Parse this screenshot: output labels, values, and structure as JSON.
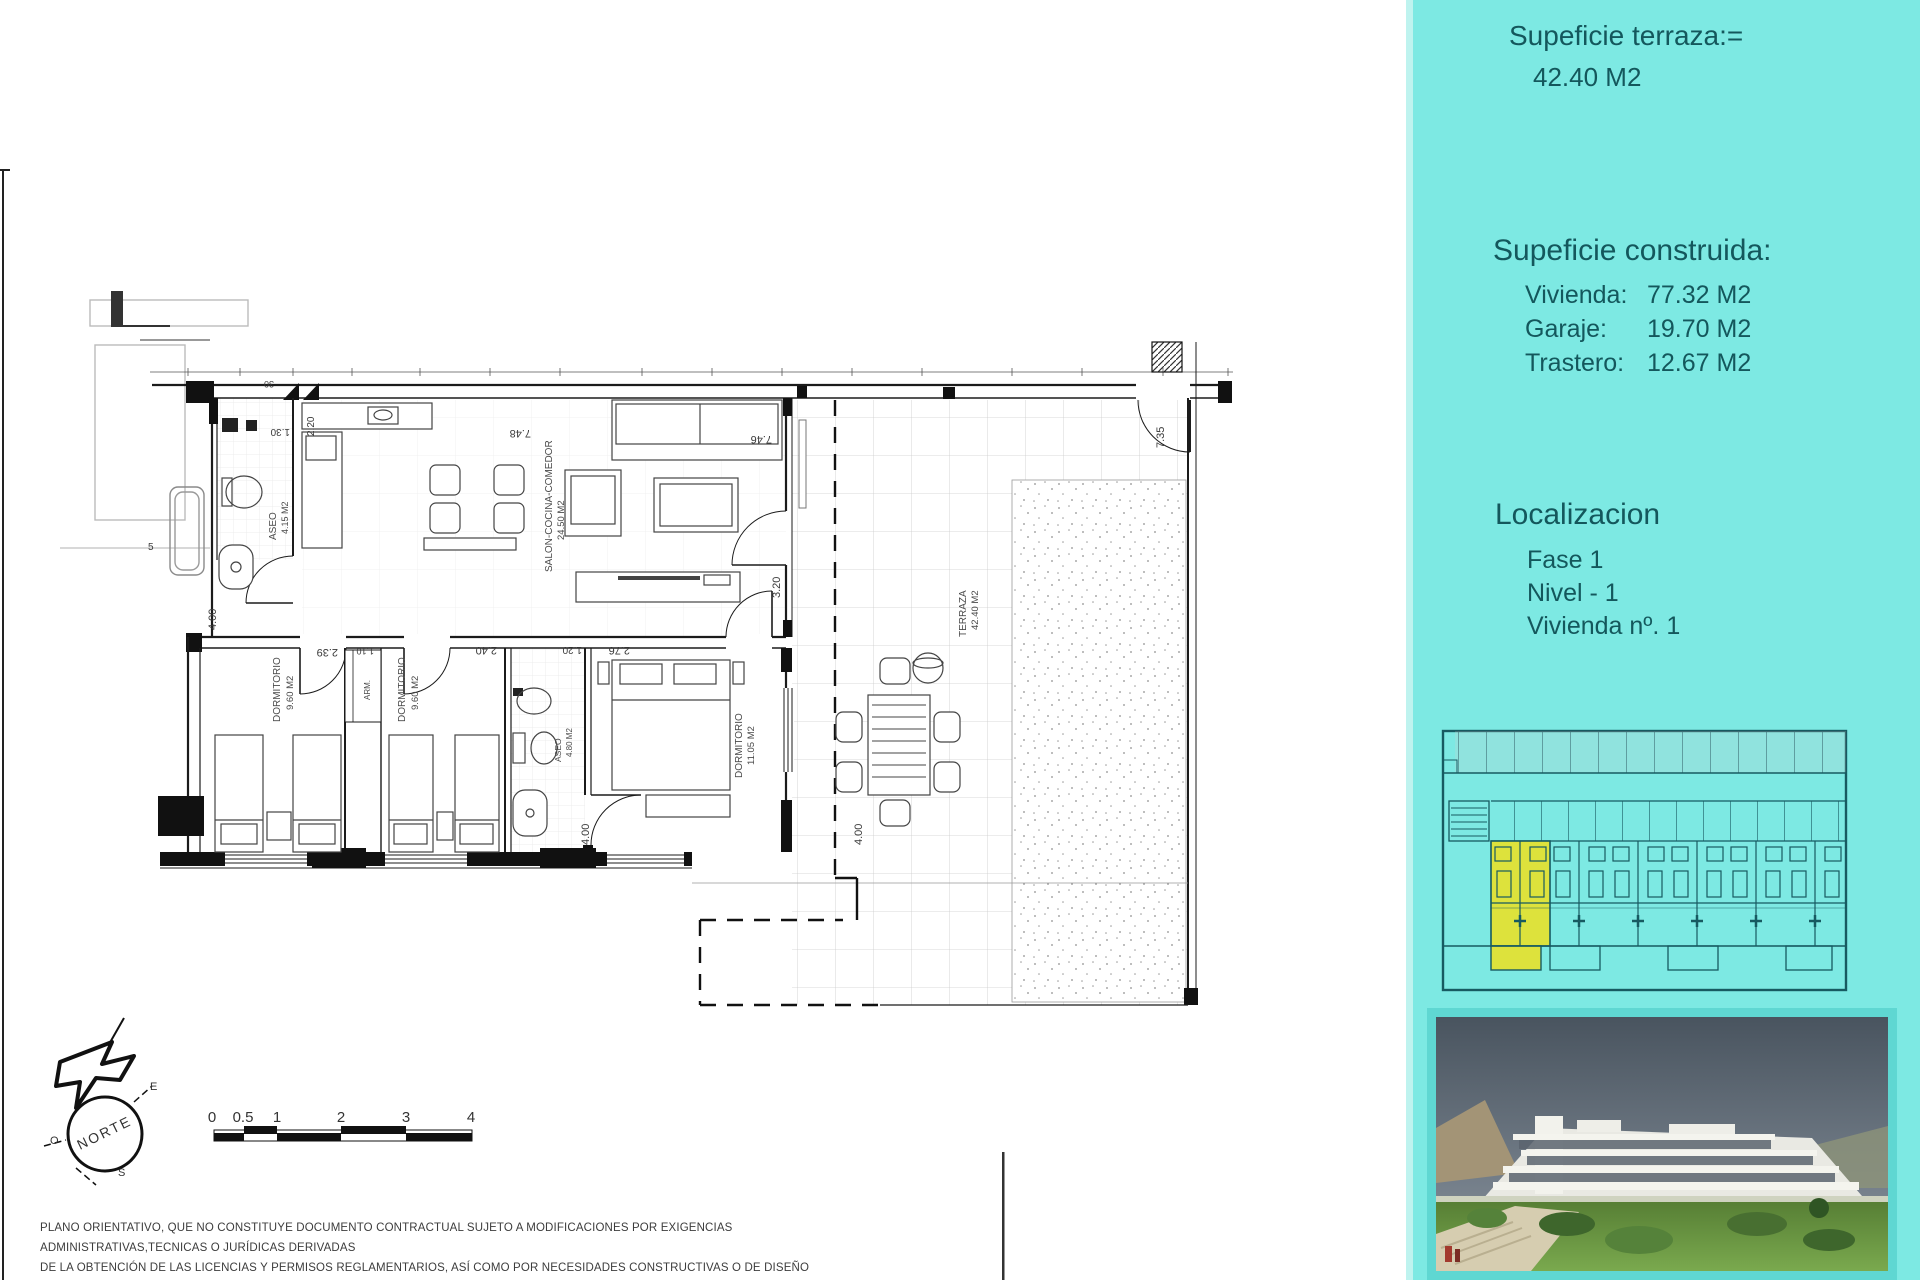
{
  "panel": {
    "terraza_title": "Supeficie terraza:=",
    "terraza_value": "42.40 M2",
    "construida_title": "Supeficie construida:",
    "construida_rows": [
      {
        "label": "Vivienda:",
        "value": "77.32 M2"
      },
      {
        "label": "Garaje:",
        "value": "19.70 M2"
      },
      {
        "label": "Trastero:",
        "value": "12.67 M2"
      }
    ],
    "localizacion_title": "Localizacion",
    "localizacion_rows": [
      "Fase 1",
      "Nivel - 1",
      "Vivienda nº. 1"
    ]
  },
  "plan": {
    "rooms": [
      {
        "name": "ASEO",
        "area": "4.15 M2"
      },
      {
        "name": "SALON-COCINA-COMEDOR",
        "area": "24.50 M2"
      },
      {
        "name": "DORMITORIO",
        "area": "9.60 M2"
      },
      {
        "name": "DORMITORIO",
        "area": "9.60 M2"
      },
      {
        "name": "ASEO",
        "area": "4.80 M2"
      },
      {
        "name": "DORMITORIO",
        "area": "11.05 M2"
      },
      {
        "name": "TERRAZA",
        "area": "42.40 M2"
      },
      {
        "name": "ARM.",
        "area": ""
      }
    ],
    "dims": {
      "d748": "7.48",
      "d746": "7.46",
      "d735": "7.35",
      "d320": "3.20",
      "d239": "2.39",
      "d110": "1.10",
      "d240": "2.40",
      "d120": "1.20",
      "d276": "2.76",
      "d400a": "4.00",
      "d400b": "4.00",
      "d400c": "4.00",
      "d130": "1.30",
      "d220": "2.20",
      "d30": "30",
      "d5": "5"
    }
  },
  "compass": {
    "north": "NORTE",
    "east": "E",
    "west": "O",
    "south": "S"
  },
  "scalebar": {
    "labels": [
      "0",
      "0.5",
      "1",
      "2",
      "3",
      "4"
    ]
  },
  "disclaimer": {
    "lines": [
      "PLANO ORIENTATIVO, QUE NO CONSTITUYE DOCUMENTO CONTRACTUAL SUJETO A MODIFICACIONES POR EXIGENCIAS ADMINISTRATIVAS,TECNICAS O JURÍDICAS DERIVADAS",
      "DE LA OBTENCIÓN DE LAS LICENCIAS Y PERMISOS REGLAMENTARIOS, ASÍ COMO POR NECESIDADES CONSTRUCTIVAS O DE DISEÑO DERIVADAS DE LA DIRECCIÓN DE LA OBRA",
      "LAS SUPERFICIES TIENEN CARÁCTER PROVISIONAL HASTA LA OBTENCIÓN DE LA LICENCIA DE PRIMERA OCUPACIÓN . EL AMUEBLAMIENTO,JARDINERIA Y MOBILIARIO URBANO"
    ]
  },
  "colors": {
    "panel_bg": "#7de9e3",
    "panel_text": "#14575c",
    "site_line": "#175a61",
    "highlight_unit": "#dde23c",
    "photo_frame": "#5fd7d2"
  }
}
